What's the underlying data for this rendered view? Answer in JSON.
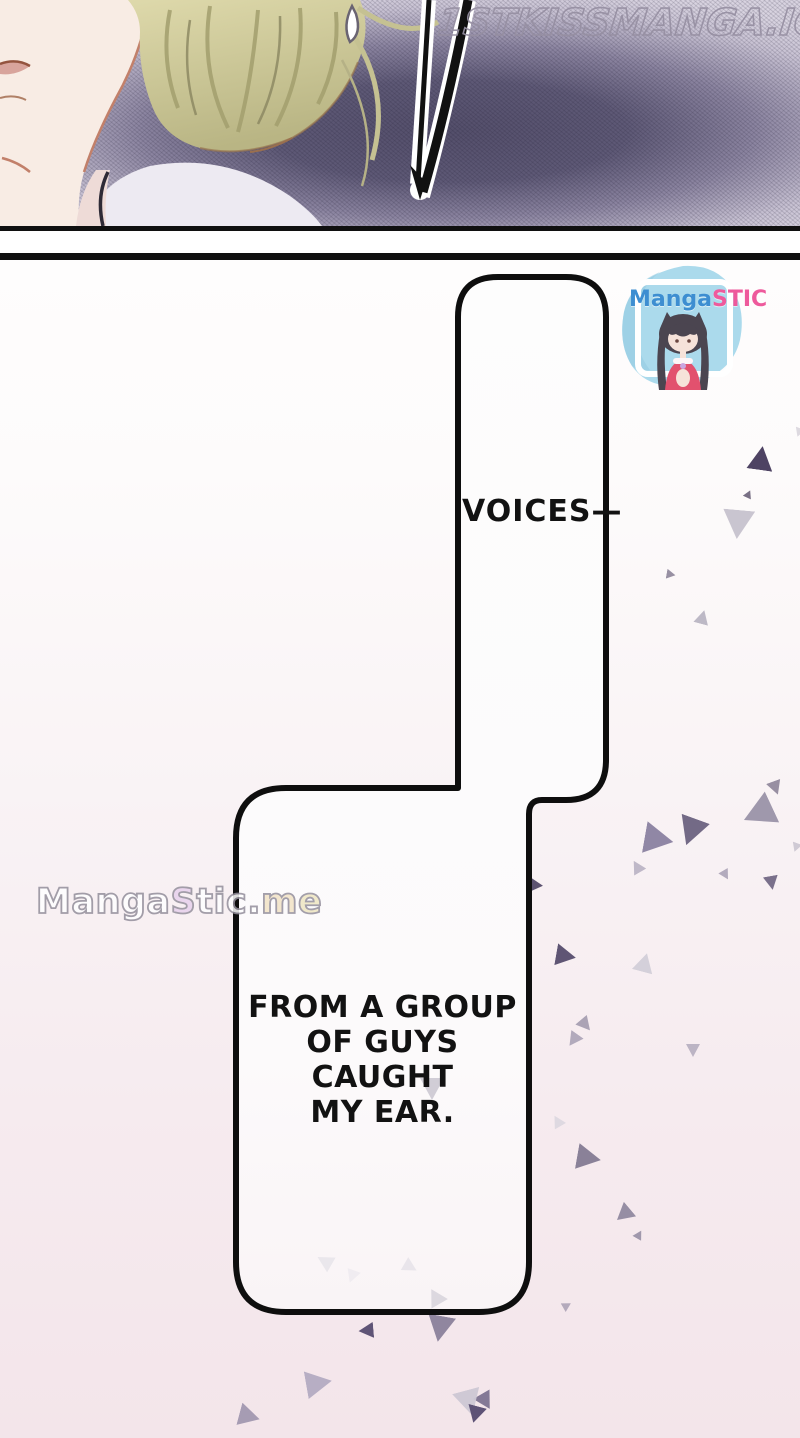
{
  "page": {
    "width": 800,
    "height": 1438
  },
  "watermarks": {
    "top": "1STKISSMANGA.IO",
    "bottom_parts": [
      {
        "text": "Manga",
        "color": "#ffffff"
      },
      {
        "text": "S",
        "color": "#e7d1ec"
      },
      {
        "text": "tic",
        "color": "#ffffff"
      },
      {
        "text": ".",
        "color": "#ffffff"
      },
      {
        "text": "m",
        "color": "#f2e3c6"
      },
      {
        "text": "e",
        "color": "#efe6c2"
      }
    ]
  },
  "speech": {
    "bubble1_text": "VOICES—",
    "bubble2_text": "FROM A GROUP\nOF GUYS CAUGHT\nMY EAR."
  },
  "sticker": {
    "brand_parts": [
      {
        "text": "Manga",
        "color": "#3d8ed1"
      },
      {
        "text": "STIC",
        "color": "#ee5a9c"
      }
    ],
    "blob_color": "#abdaec"
  },
  "art_colors": {
    "panel_bg_center": "#544f6b",
    "panel_bg_edge": "#d8d3e0",
    "skin": "#f8ece4",
    "hair_light": "#ded9ab",
    "hair_dark": "#b9b584",
    "collar": "#edeaf2",
    "lips": "#d8a49c",
    "bubble_border": "#0e0e0e"
  },
  "confetti": {
    "outside": [
      {
        "x": 748,
        "y": 446,
        "s": 26,
        "r": 8,
        "c": "#4e4363",
        "o": 1
      },
      {
        "x": 744,
        "y": 490,
        "s": 9,
        "r": 25,
        "c": "#6a6078",
        "o": 0.9
      },
      {
        "x": 722,
        "y": 510,
        "s": 32,
        "r": 185,
        "c": "#c6c2cd",
        "o": 0.95
      },
      {
        "x": 666,
        "y": 570,
        "s": 10,
        "r": 100,
        "c": "#8d8499",
        "o": 0.9
      },
      {
        "x": 695,
        "y": 610,
        "s": 15,
        "r": 15,
        "c": "#b6b1c0",
        "o": 0.9
      },
      {
        "x": 794,
        "y": 428,
        "s": 10,
        "r": 200,
        "c": "#d5d1da",
        "o": 0.8
      },
      {
        "x": 741,
        "y": 798,
        "s": 34,
        "r": 245,
        "c": "#9a92a8",
        "o": 0.95
      },
      {
        "x": 768,
        "y": 781,
        "s": 15,
        "r": 160,
        "c": "#8d8499",
        "o": 0.9
      },
      {
        "x": 643,
        "y": 825,
        "s": 32,
        "r": 100,
        "c": "#8a81a0",
        "o": 0.95
      },
      {
        "x": 676,
        "y": 818,
        "s": 30,
        "r": 200,
        "c": "#6c6280",
        "o": 0.95
      },
      {
        "x": 630,
        "y": 860,
        "s": 14,
        "r": 330,
        "c": "#b5aec0",
        "o": 0.85
      },
      {
        "x": 720,
        "y": 870,
        "s": 11,
        "r": 150,
        "c": "#a79fb3",
        "o": 0.85
      },
      {
        "x": 764,
        "y": 876,
        "s": 15,
        "r": 170,
        "c": "#6c6280",
        "o": 0.9
      },
      {
        "x": 791,
        "y": 843,
        "s": 10,
        "r": 200,
        "c": "#c4bfcc",
        "o": 0.8
      },
      {
        "x": 524,
        "y": 876,
        "s": 20,
        "r": 95,
        "c": "#5c5270",
        "o": 1
      },
      {
        "x": 555,
        "y": 946,
        "s": 22,
        "r": 100,
        "c": "#5f5574",
        "o": 1
      },
      {
        "x": 634,
        "y": 953,
        "s": 21,
        "r": 15,
        "c": "#d2ced8",
        "o": 0.95
      },
      {
        "x": 578,
        "y": 1018,
        "s": 15,
        "r": 140,
        "c": "#a29aae",
        "o": 0.9
      },
      {
        "x": 566,
        "y": 1033,
        "s": 15,
        "r": 215,
        "c": "#aaa2b6",
        "o": 0.9
      },
      {
        "x": 686,
        "y": 1044,
        "s": 14,
        "r": 180,
        "c": "#b1a9bc",
        "o": 0.85
      },
      {
        "x": 551,
        "y": 1115,
        "s": 13,
        "r": 330,
        "c": "#d8d4dd",
        "o": 0.8
      },
      {
        "x": 576,
        "y": 1146,
        "s": 26,
        "r": 100,
        "c": "#8a8198",
        "o": 1
      },
      {
        "x": 614,
        "y": 1206,
        "s": 19,
        "r": 230,
        "c": "#9089a0",
        "o": 0.95
      },
      {
        "x": 634,
        "y": 1230,
        "s": 10,
        "r": 30,
        "c": "#9089a0",
        "o": 0.85
      },
      {
        "x": 562,
        "y": 1301,
        "s": 10,
        "r": 60,
        "c": "#a89fb4",
        "o": 0.85
      },
      {
        "x": 476,
        "y": 1393,
        "s": 19,
        "r": 150,
        "c": "#7d7391",
        "o": 0.95
      },
      {
        "x": 358,
        "y": 1323,
        "s": 16,
        "r": 265,
        "c": "#5f5476",
        "o": 1
      },
      {
        "x": 426,
        "y": 1316,
        "s": 28,
        "r": 190,
        "c": "#8a819b",
        "o": 0.95
      },
      {
        "x": 305,
        "y": 1370,
        "s": 28,
        "r": 80,
        "c": "#b3abc2",
        "o": 0.95
      },
      {
        "x": 238,
        "y": 1406,
        "s": 23,
        "r": 105,
        "c": "#9d94ad",
        "o": 0.9
      },
      {
        "x": 455,
        "y": 1390,
        "s": 28,
        "r": 165,
        "c": "#ccc7d4",
        "o": 0.95
      },
      {
        "x": 466,
        "y": 1406,
        "s": 19,
        "r": 195,
        "c": "#5d5276",
        "o": 1
      }
    ],
    "inside": [
      {
        "x": 420,
        "y": 1078,
        "s": 24,
        "r": 180,
        "c": "#c9c5cf",
        "o": 0.85
      },
      {
        "x": 426,
        "y": 1288,
        "s": 19,
        "r": 330,
        "c": "#d5d1da",
        "o": 0.8
      },
      {
        "x": 316,
        "y": 1253,
        "s": 17,
        "r": 300,
        "c": "#e4e1e8",
        "o": 0.75
      },
      {
        "x": 403,
        "y": 1260,
        "s": 15,
        "r": 120,
        "c": "#dddae2",
        "o": 0.6
      },
      {
        "x": 345,
        "y": 1270,
        "s": 14,
        "r": 200,
        "c": "#e9e6ec",
        "o": 0.6
      }
    ]
  }
}
